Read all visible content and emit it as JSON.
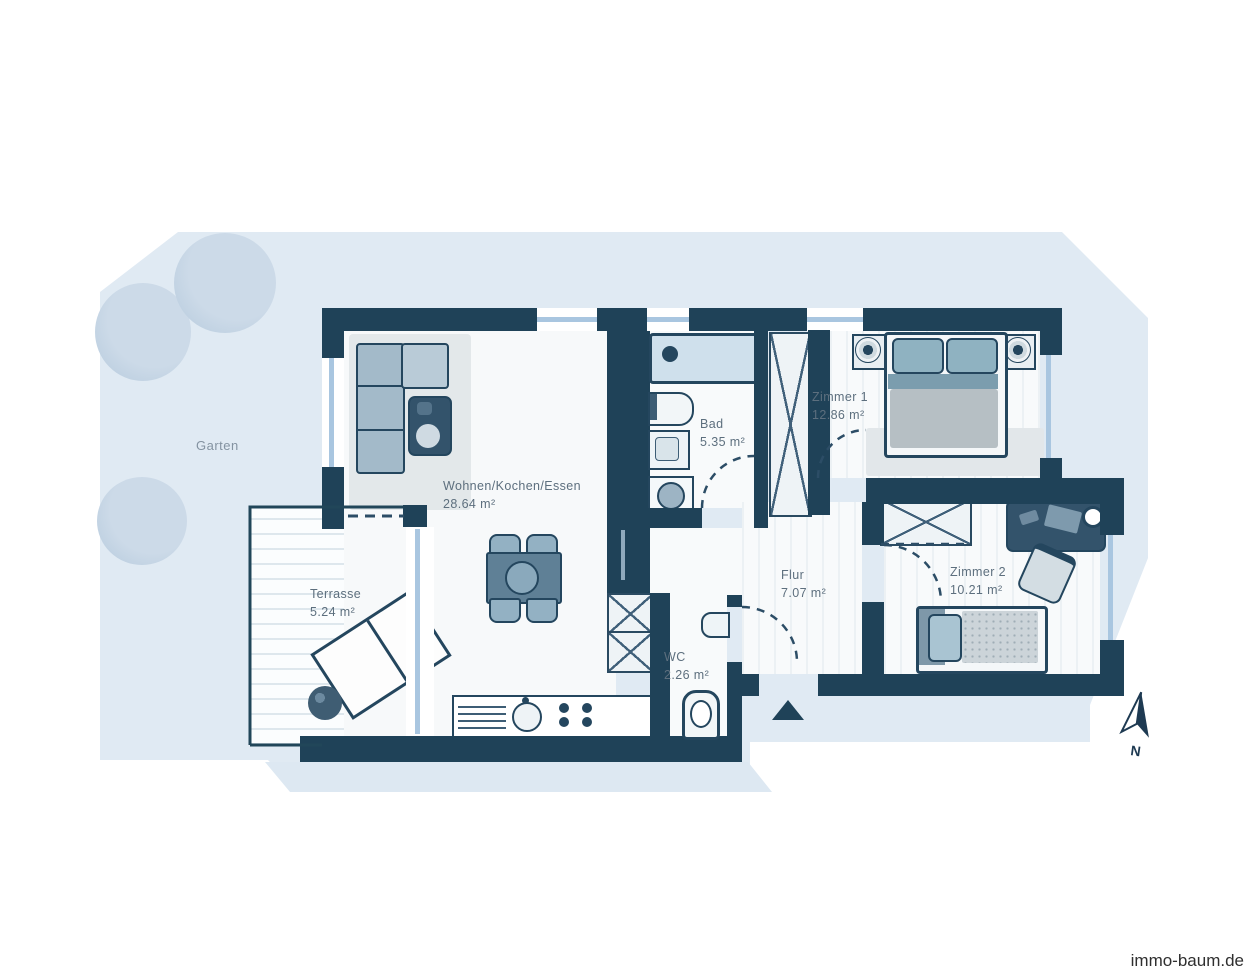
{
  "watermark": {
    "text": "immo-baum.de"
  },
  "garden": {
    "label": "Garten"
  },
  "compass": {
    "label": "N"
  },
  "rooms": {
    "wohnen": {
      "name": "Wohnen/Kochen/Essen",
      "area": "28.64 m²"
    },
    "bad": {
      "name": "Bad",
      "area": "5.35 m²"
    },
    "zimmer1": {
      "name": "Zimmer 1",
      "area": "12.86 m²"
    },
    "flur": {
      "name": "Flur",
      "area": "7.07 m²"
    },
    "wc": {
      "name": "WC",
      "area": "2.26 m²"
    },
    "zimmer2": {
      "name": "Zimmer 2",
      "area": "10.21 m²"
    },
    "terrasse": {
      "name": "Terrasse",
      "area": "5.24 m²"
    }
  },
  "colors": {
    "wall": "#1f4258",
    "garden": "#e0eaf3",
    "window": "#a9c6e0",
    "furniture_light": "#9db7c8",
    "furniture_dark": "#33536b",
    "label_text": "#5d6f7e"
  }
}
